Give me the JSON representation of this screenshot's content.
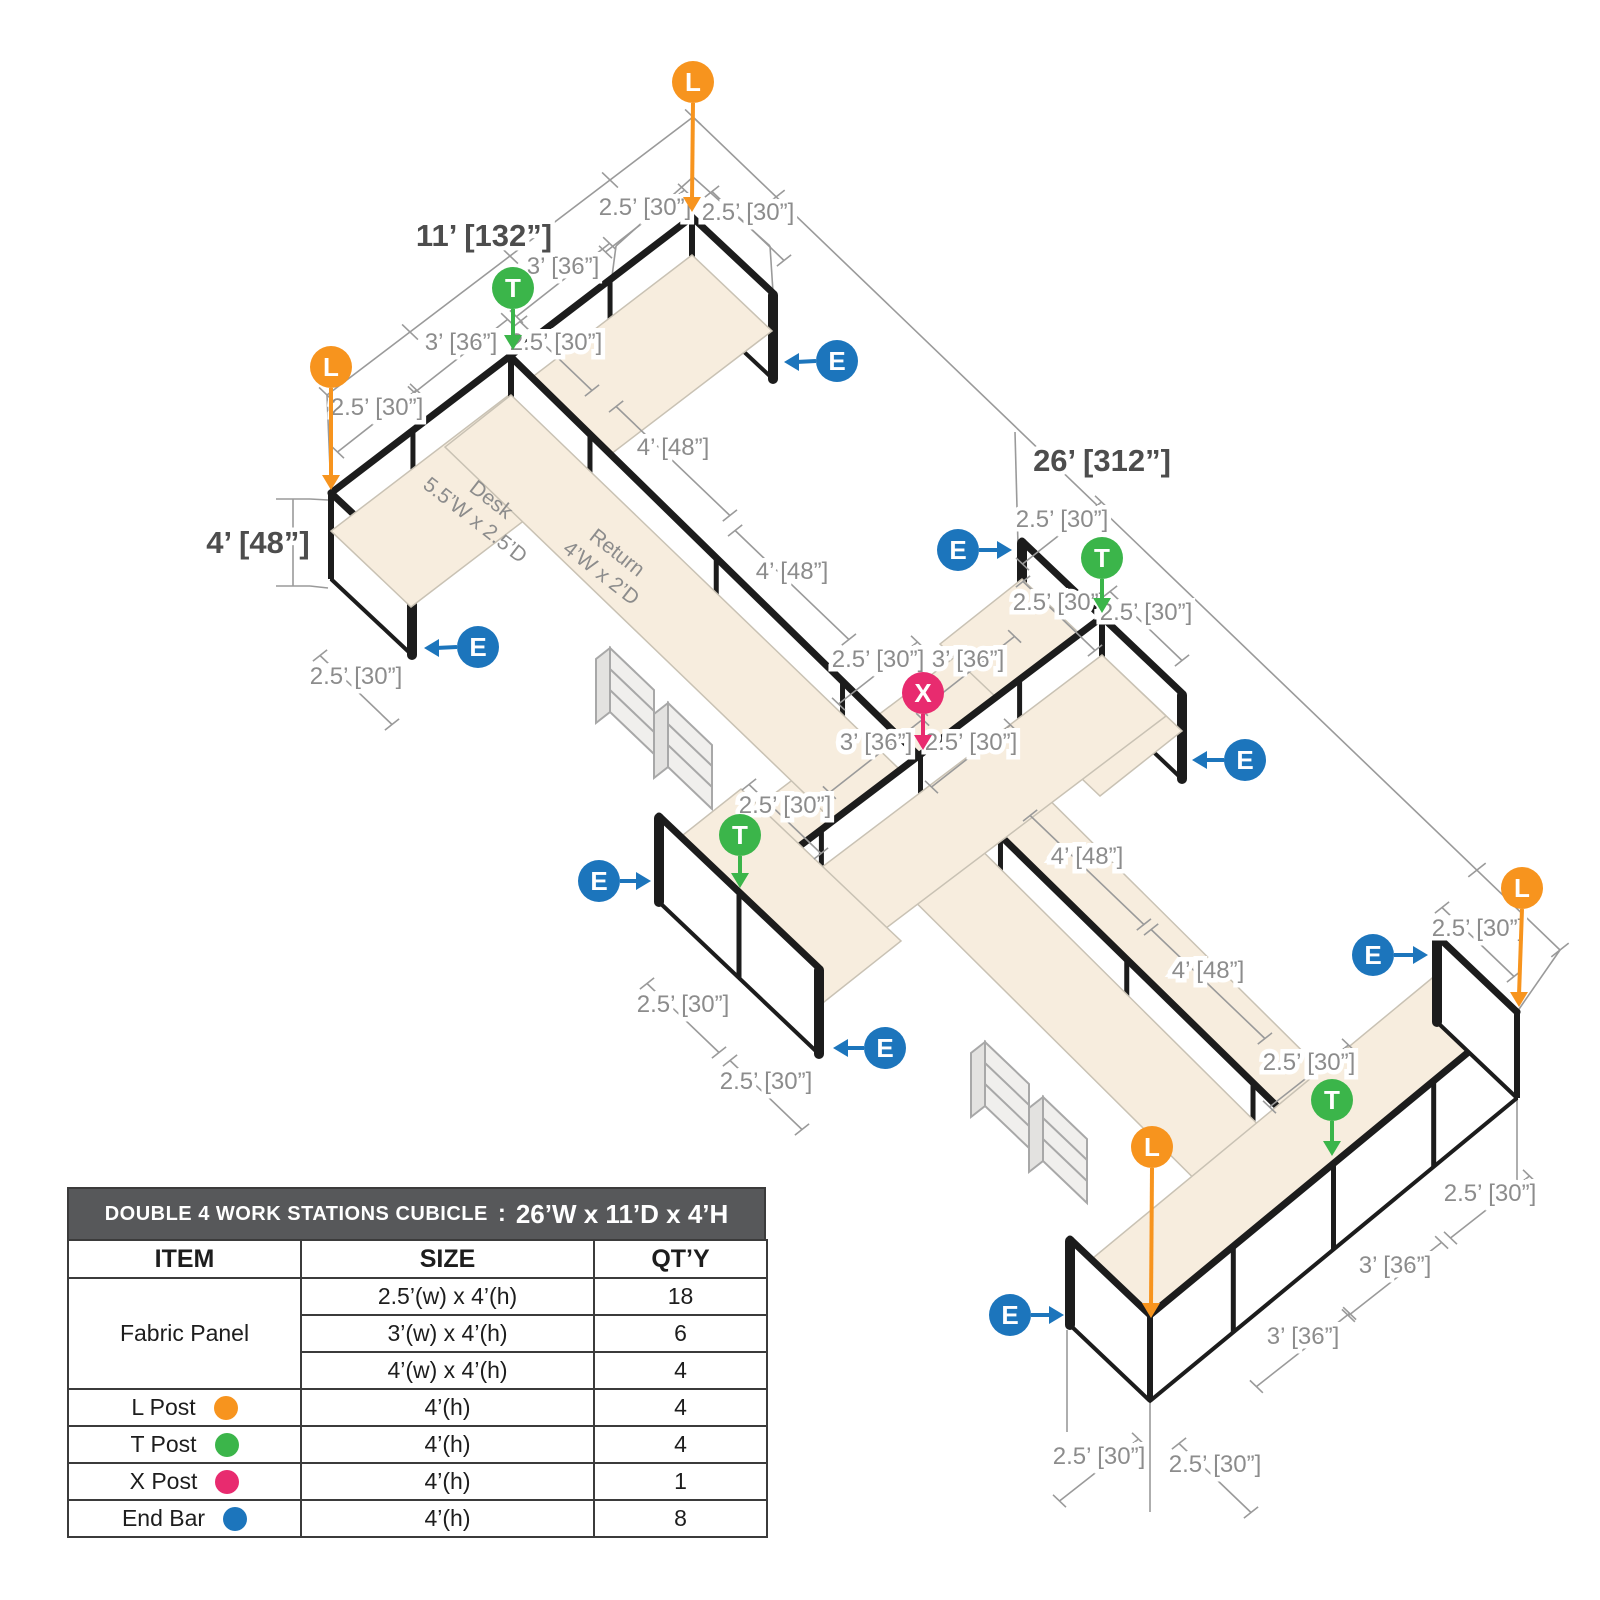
{
  "diagram": {
    "colors": {
      "post_L": "#F7941E",
      "post_T": "#3BB54A",
      "post_X": "#E82B6F",
      "end_bar_E": "#1C75BC",
      "desk_surface": "#F7EDDE",
      "panel_line": "#1C1C1C",
      "dim_text": "#8C8C8C",
      "bold_dim_text": "#4D4D4D"
    },
    "bold_labels": [
      {
        "t": "11’ [132”]",
        "x": 484,
        "y": 236
      },
      {
        "t": "26’ [312”]",
        "x": 1102,
        "y": 461
      },
      {
        "t": "4’ [48”]",
        "x": 258,
        "y": 543
      }
    ],
    "dim_labels": [
      {
        "t": "2.5’ [30”]",
        "x": 645,
        "y": 207,
        "a": "v",
        "l": 100
      },
      {
        "t": "2.5’ [30”]",
        "x": 748,
        "y": 212,
        "a": "u",
        "l": 100
      },
      {
        "t": "3’ [36”]",
        "x": 563,
        "y": 266,
        "a": "v",
        "l": 118
      },
      {
        "t": "3’ [36”]",
        "x": 461,
        "y": 342,
        "a": "v",
        "l": 118
      },
      {
        "t": "2.5’ [30”]",
        "x": 556,
        "y": 342,
        "a": "u",
        "l": 100
      },
      {
        "t": "2.5’ [30”]",
        "x": 377,
        "y": 407,
        "a": "v",
        "l": 100
      },
      {
        "t": "4’ [48”]",
        "x": 673,
        "y": 447,
        "a": "u",
        "l": 158
      },
      {
        "t": "4’ [48”]",
        "x": 792,
        "y": 571,
        "a": "u",
        "l": 158
      },
      {
        "t": "2.5’ [30”]",
        "x": 356,
        "y": 676,
        "a": "u",
        "l": 100
      },
      {
        "t": "2.5’ [30”]",
        "x": 1062,
        "y": 519,
        "a": "v",
        "l": 100
      },
      {
        "t": "2.5’ [30”]",
        "x": 1059,
        "y": 602,
        "a": "u",
        "l": 100
      },
      {
        "t": "2.5’ [30”]",
        "x": 1146,
        "y": 612,
        "a": "u",
        "l": 100
      },
      {
        "t": "2.5’ [30”]",
        "x": 878,
        "y": 659,
        "a": "v",
        "l": 100
      },
      {
        "t": "3’ [36”]",
        "x": 968,
        "y": 659,
        "a": "v",
        "l": 118
      },
      {
        "t": "3’ [36”]",
        "x": 876,
        "y": 742,
        "a": "v",
        "l": 118
      },
      {
        "t": "2.5’ [30”]",
        "x": 971,
        "y": 742,
        "a": "v",
        "l": 100
      },
      {
        "t": "2.5’ [30”]",
        "x": 785,
        "y": 805,
        "a": "u",
        "l": 100
      },
      {
        "t": "2.5’ [30”]",
        "x": 683,
        "y": 1004,
        "a": "u",
        "l": 100
      },
      {
        "t": "2.5’ [30”]",
        "x": 766,
        "y": 1081,
        "a": "u",
        "l": 100
      },
      {
        "t": "4’ [48”]",
        "x": 1087,
        "y": 856,
        "a": "u",
        "l": 158
      },
      {
        "t": "4’ [48”]",
        "x": 1208,
        "y": 970,
        "a": "u",
        "l": 158
      },
      {
        "t": "2.5’ [30”]",
        "x": 1478,
        "y": 928,
        "a": "u",
        "l": 100
      },
      {
        "t": "2.5’ [30”]",
        "x": 1309,
        "y": 1062,
        "a": "v",
        "l": 100
      },
      {
        "t": "2.5’ [30”]",
        "x": 1490,
        "y": 1193,
        "a": "v",
        "l": 100
      },
      {
        "t": "3’ [36”]",
        "x": 1395,
        "y": 1265,
        "a": "v",
        "l": 118
      },
      {
        "t": "3’ [36”]",
        "x": 1303,
        "y": 1336,
        "a": "v",
        "l": 118
      },
      {
        "t": "2.5’ [30”]",
        "x": 1099,
        "y": 1456,
        "a": "v",
        "l": 100
      },
      {
        "t": "2.5’ [30”]",
        "x": 1215,
        "y": 1464,
        "a": "u",
        "l": 100
      }
    ],
    "markers": [
      {
        "k": "L",
        "x": 693,
        "y": 82,
        "tx": 692,
        "ty": 212,
        "d": "down"
      },
      {
        "k": "T",
        "x": 513,
        "y": 288,
        "tx": 513,
        "ty": 350,
        "d": "down"
      },
      {
        "k": "L",
        "x": 331,
        "y": 367,
        "tx": 331,
        "ty": 490,
        "d": "down"
      },
      {
        "k": "E",
        "x": 837,
        "y": 361,
        "tx": 784,
        "ty": 362,
        "d": "left"
      },
      {
        "k": "E",
        "x": 958,
        "y": 550,
        "tx": 1012,
        "ty": 550,
        "d": "right"
      },
      {
        "k": "T",
        "x": 1102,
        "y": 558,
        "tx": 1102,
        "ty": 613,
        "d": "down"
      },
      {
        "k": "X",
        "x": 923,
        "y": 693,
        "tx": 923,
        "ty": 750,
        "d": "down"
      },
      {
        "k": "E",
        "x": 1245,
        "y": 760,
        "tx": 1192,
        "ty": 760,
        "d": "left"
      },
      {
        "k": "E",
        "x": 478,
        "y": 647,
        "tx": 424,
        "ty": 648,
        "d": "left"
      },
      {
        "k": "E",
        "x": 599,
        "y": 881,
        "tx": 651,
        "ty": 881,
        "d": "right"
      },
      {
        "k": "T",
        "x": 740,
        "y": 835,
        "tx": 740,
        "ty": 888,
        "d": "down"
      },
      {
        "k": "E",
        "x": 885,
        "y": 1048,
        "tx": 833,
        "ty": 1048,
        "d": "left"
      },
      {
        "k": "L",
        "x": 1522,
        "y": 888,
        "tx": 1519,
        "ty": 1007,
        "d": "down"
      },
      {
        "k": "E",
        "x": 1373,
        "y": 955,
        "tx": 1428,
        "ty": 955,
        "d": "right"
      },
      {
        "k": "T",
        "x": 1332,
        "y": 1100,
        "tx": 1332,
        "ty": 1156,
        "d": "down"
      },
      {
        "k": "L",
        "x": 1152,
        "y": 1147,
        "tx": 1151,
        "ty": 1318,
        "d": "down"
      },
      {
        "k": "E",
        "x": 1010,
        "y": 1315,
        "tx": 1064,
        "ty": 1315,
        "d": "right"
      }
    ],
    "desk_texts": [
      {
        "line1": "Desk",
        "line2": "5.5’W x 2.5’D",
        "x": 487,
        "y": 505,
        "rot": 38
      },
      {
        "line1": "Return",
        "line2": "4’W x 2’D",
        "x": 613,
        "y": 558,
        "rot": 38
      }
    ]
  },
  "table": {
    "title": "DOUBLE 4 WORK STATIONS  CUBICLE",
    "title_colon": ":",
    "title_dims": "26’W x 11’D x 4’H",
    "columns": [
      "ITEM",
      "SIZE",
      "QT’Y"
    ],
    "fabric": {
      "label": "Fabric Panel",
      "sizes": [
        {
          "size": "2.5’(w) x 4’(h)",
          "qty": "18"
        },
        {
          "size": "3’(w) x 4’(h)",
          "qty": "6"
        },
        {
          "size": "4’(w) x 4’(h)",
          "qty": "4"
        }
      ]
    },
    "posts": [
      {
        "label": "L Post",
        "color": "#F7941E",
        "size": "4’(h)",
        "qty": "4"
      },
      {
        "label": "T Post",
        "color": "#3BB54A",
        "size": "4’(h)",
        "qty": "4"
      },
      {
        "label": "X Post",
        "color": "#E82B6F",
        "size": "4’(h)",
        "qty": "1"
      },
      {
        "label": "End Bar",
        "color": "#1C75BC",
        "size": "4’(h)",
        "qty": "8"
      }
    ]
  }
}
